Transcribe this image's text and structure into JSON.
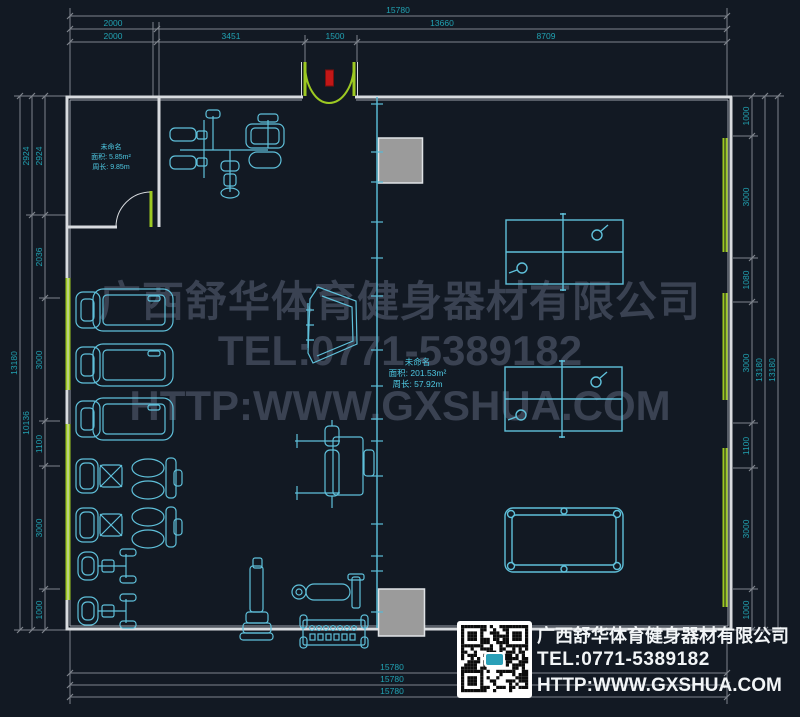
{
  "plan_labels": {
    "room_small": {
      "name": "未命名",
      "area": "面积: 5.85m²",
      "perimeter": "周长: 9.85m"
    },
    "room_main": {
      "name": "未命名",
      "area": "面积: 201.53m²",
      "perimeter": "周长: 57.92m"
    }
  },
  "dimensions": {
    "top": {
      "total": "15780",
      "row2": [
        "2000",
        "13660"
      ],
      "row3": [
        "2000",
        "3451",
        "1500",
        "8709"
      ]
    },
    "bottom": [
      "15780",
      "15780",
      "15780"
    ],
    "left": {
      "total": "13180",
      "mid": [
        "2924",
        "10136"
      ],
      "inner": [
        "2924",
        "2036",
        "3000",
        "1100",
        "3000",
        "1000"
      ]
    },
    "right": {
      "totals": [
        "13180",
        "13180"
      ],
      "inner": [
        "1000",
        "3000",
        "1080",
        "3000",
        "1100",
        "3000",
        "1000"
      ]
    }
  },
  "watermark": [
    "广西舒华体育健身器材有限公司",
    "TEL:0771-5389182",
    "HTTP:WWW.GXSHUA.COM"
  ],
  "contact": {
    "company": "广西舒华体育健身器材有限公司",
    "tel": "TEL:0771-5389182",
    "url": "HTTP:WWW.GXSHUA.COM"
  },
  "icons": {
    "qr": "qr-code",
    "entrance_marker": "red-entrance-marker",
    "windows": "green-window-strips"
  },
  "equipment": [
    "multi-station-gym",
    "treadmill x3",
    "situp-board",
    "bench-press",
    "elliptical x2",
    "exercise-bike x2",
    "weight-tower",
    "roller-bench",
    "dumbbell-rack",
    "ping-pong-table x2",
    "pool-table"
  ],
  "colors": {
    "background": "#121923",
    "wall": "#d8dbdf",
    "equipment_line": "#5fc0da",
    "dimension_text": "#21a2b2",
    "dimension_line": "#7e848c",
    "window_green": "#9dc922",
    "entrance_red": "#c21717",
    "watermark": "#3a4252",
    "column_fill": "#9b9b9b",
    "contact_text": "#f2f5f7"
  }
}
